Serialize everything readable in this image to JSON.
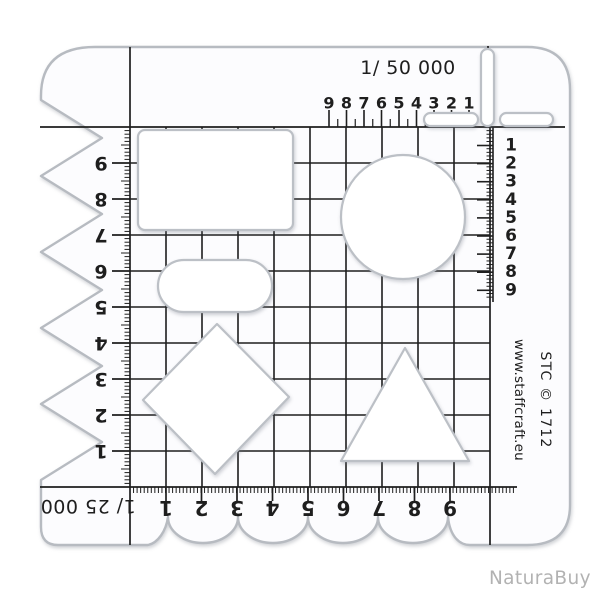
{
  "photo": {
    "watermark": "NaturaBuy"
  },
  "template": {
    "scale_top": "1/ 50 000",
    "scale_bottom": "1/ 25 000",
    "brand_line1": "STC © 1712",
    "brand_line2": "www.staffcraft.eu",
    "rulers": {
      "top": [
        "9",
        "8",
        "7",
        "6",
        "5",
        "4",
        "3",
        "2",
        "1"
      ],
      "left": [
        "9",
        "8",
        "7",
        "6",
        "5",
        "4",
        "3",
        "2",
        "1"
      ],
      "right": [
        "1",
        "2",
        "3",
        "4",
        "5",
        "6",
        "7",
        "8",
        "9"
      ],
      "bottom": [
        "1",
        "2",
        "3",
        "4",
        "5",
        "6",
        "7",
        "8",
        "9"
      ]
    },
    "cutouts": [
      "rectangle",
      "rounded-rectangle",
      "circle",
      "diamond",
      "triangle",
      "slot-vertical",
      "slot-horizontal-left",
      "slot-horizontal-right"
    ],
    "colors": {
      "print": "#1e1e1e",
      "plastic_edge": "#b7bbc1",
      "watermark": "#b2b2b2"
    }
  }
}
